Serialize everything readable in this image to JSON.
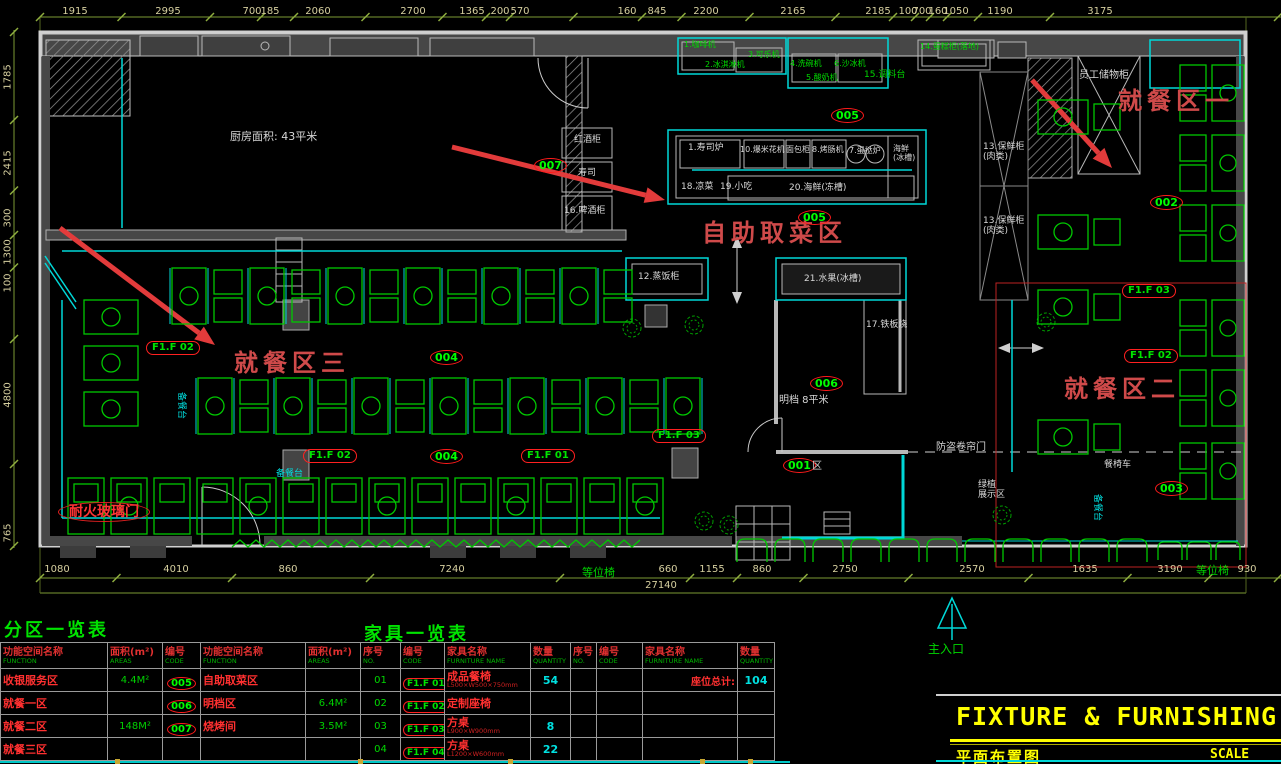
{
  "titles": {
    "zone_table": "分区一览表",
    "furniture_table": "家具一览表",
    "fixture_en": "FIXTURE & FURNISHING P",
    "plan_cn": "平面布置图",
    "scale": "SCALE"
  },
  "colors": {
    "furniture_green": "#00c800",
    "counter_cyan": "#00d8d8",
    "label_red": "#cf4a4a",
    "code_green": "#00ff00",
    "dim_tan": "#d6cf9f",
    "title_yellow": "#ffff00",
    "wall_gray": "#474747"
  },
  "dims": {
    "top": [
      {
        "t": "1915",
        "x": 75
      },
      {
        "t": "2995",
        "x": 168
      },
      {
        "t": "700",
        "x": 252
      },
      {
        "t": "185",
        "x": 270
      },
      {
        "t": "2060",
        "x": 318
      },
      {
        "t": "2700",
        "x": 413
      },
      {
        "t": "1365",
        "x": 472
      },
      {
        "t": "200",
        "x": 500
      },
      {
        "t": "570",
        "x": 520
      },
      {
        "t": "160",
        "x": 627
      },
      {
        "t": "845",
        "x": 657
      },
      {
        "t": "2200",
        "x": 706
      },
      {
        "t": "2165",
        "x": 793
      },
      {
        "t": "2185",
        "x": 878
      },
      {
        "t": "100",
        "x": 908
      },
      {
        "t": "700",
        "x": 922
      },
      {
        "t": "160",
        "x": 938
      },
      {
        "t": "1050",
        "x": 956
      },
      {
        "t": "1190",
        "x": 1000
      },
      {
        "t": "3175",
        "x": 1100
      }
    ],
    "left": [
      {
        "t": "1785",
        "y": 77
      },
      {
        "t": "2415",
        "y": 163
      },
      {
        "t": "300",
        "y": 218
      },
      {
        "t": "1300",
        "y": 252
      },
      {
        "t": "100",
        "y": 283
      },
      {
        "t": "4800",
        "y": 395
      },
      {
        "t": "765",
        "y": 533
      }
    ],
    "bottom": [
      {
        "t": "1080",
        "x": 57
      },
      {
        "t": "4010",
        "x": 176
      },
      {
        "t": "860",
        "x": 288
      },
      {
        "t": "7240",
        "x": 452
      },
      {
        "t": "660",
        "x": 668
      },
      {
        "t": "1155",
        "x": 712
      },
      {
        "t": "860",
        "x": 762
      },
      {
        "t": "2750",
        "x": 845
      },
      {
        "t": "2570",
        "x": 972
      },
      {
        "t": "1635",
        "x": 1085
      },
      {
        "t": "3190",
        "x": 1170
      },
      {
        "t": "930",
        "x": 1247
      }
    ],
    "total": {
      "t": "27140",
      "x": 661,
      "y": 580
    }
  },
  "plan": {
    "area_labels": [
      {
        "t": "就餐区一",
        "x": 1118,
        "y": 88
      },
      {
        "t": "自助取菜区",
        "x": 702,
        "y": 220
      },
      {
        "t": "就餐区三",
        "x": 234,
        "y": 350
      },
      {
        "t": "就餐区二",
        "x": 1064,
        "y": 376
      }
    ],
    "codes": [
      {
        "t": "005",
        "x": 831,
        "y": 108
      },
      {
        "t": "007",
        "x": 534,
        "y": 158
      },
      {
        "t": "005",
        "x": 798,
        "y": 210
      },
      {
        "t": "006",
        "x": 810,
        "y": 376
      },
      {
        "t": "004",
        "x": 430,
        "y": 350
      },
      {
        "t": "004",
        "x": 430,
        "y": 449
      },
      {
        "t": "002",
        "x": 1150,
        "y": 195
      },
      {
        "t": "003",
        "x": 1155,
        "y": 481
      },
      {
        "t": "001",
        "x": 783,
        "y": 458
      }
    ],
    "ftags": [
      {
        "t": "F1.F 03",
        "x": 1122,
        "y": 284
      },
      {
        "t": "F1.F 02",
        "x": 1124,
        "y": 349
      },
      {
        "t": "F1.F 02",
        "x": 146,
        "y": 341
      },
      {
        "t": "F1.F 02",
        "x": 303,
        "y": 449
      },
      {
        "t": "F1.F 01",
        "x": 521,
        "y": 449
      },
      {
        "t": "F1.F 03",
        "x": 652,
        "y": 429
      }
    ],
    "white_labels": [
      {
        "t": "厨房面积: 43平米",
        "x": 230,
        "y": 131,
        "s": 11
      },
      {
        "t": "员工储物柜",
        "x": 1079,
        "y": 70,
        "s": 10
      },
      {
        "t": "13.保鲜柜\n(肉类)",
        "x": 983,
        "y": 142,
        "s": 9
      },
      {
        "t": "13.保鲜柜\n(肉类)",
        "x": 983,
        "y": 216,
        "s": 9
      },
      {
        "t": "红酒柜",
        "x": 574,
        "y": 135,
        "s": 9
      },
      {
        "t": "寿司",
        "x": 578,
        "y": 168,
        "s": 9
      },
      {
        "t": "16.啤酒柜",
        "x": 564,
        "y": 206,
        "s": 9
      },
      {
        "t": "1.寿司炉",
        "x": 688,
        "y": 143,
        "s": 9
      },
      {
        "t": "10.爆米花机",
        "x": 740,
        "y": 145,
        "s": 8
      },
      {
        "t": "面包柜",
        "x": 786,
        "y": 145,
        "s": 8
      },
      {
        "t": "8.烤肠机",
        "x": 812,
        "y": 145,
        "s": 8
      },
      {
        "t": "7.蛋挞炉",
        "x": 849,
        "y": 146,
        "s": 8
      },
      {
        "t": "海鲜\n(冰槽)",
        "x": 893,
        "y": 144,
        "s": 8
      },
      {
        "t": "18.凉菜",
        "x": 681,
        "y": 182,
        "s": 9
      },
      {
        "t": "19.小吃",
        "x": 720,
        "y": 182,
        "s": 9
      },
      {
        "t": "20.海鲜(冻槽)",
        "x": 789,
        "y": 183,
        "s": 9
      },
      {
        "t": "12.蒸饭柜",
        "x": 638,
        "y": 272,
        "s": 9
      },
      {
        "t": "21.水果(冰槽)",
        "x": 804,
        "y": 274,
        "s": 9
      },
      {
        "t": "17.铁板烧",
        "x": 866,
        "y": 320,
        "s": 9
      },
      {
        "t": "明档 8平米",
        "x": 779,
        "y": 395,
        "s": 10
      },
      {
        "t": "防盗卷帘门",
        "x": 936,
        "y": 442,
        "s": 10
      },
      {
        "t": "绿植\n展示区",
        "x": 978,
        "y": 480,
        "s": 9
      },
      {
        "t": "餐椅车",
        "x": 1104,
        "y": 460,
        "s": 9
      },
      {
        "t": "区",
        "x": 812,
        "y": 461,
        "s": 10
      }
    ],
    "green_labels": [
      {
        "t": "1.咖啡机",
        "x": 684,
        "y": 40,
        "s": 8
      },
      {
        "t": "2.冰淇淋机",
        "x": 705,
        "y": 60,
        "s": 8
      },
      {
        "t": "3.可乐机",
        "x": 748,
        "y": 50,
        "s": 8
      },
      {
        "t": "4.洗碗机",
        "x": 790,
        "y": 59,
        "s": 8
      },
      {
        "t": "6.沙冰机",
        "x": 834,
        "y": 59,
        "s": 8
      },
      {
        "t": "5.酸奶机",
        "x": 806,
        "y": 73,
        "s": 8
      },
      {
        "t": "15.调料台",
        "x": 864,
        "y": 70,
        "s": 9
      },
      {
        "t": "14.蛋糕柜(落地)",
        "x": 920,
        "y": 42,
        "s": 8
      },
      {
        "t": "等位椅",
        "x": 582,
        "y": 567,
        "s": 11
      },
      {
        "t": "等位椅",
        "x": 1196,
        "y": 565,
        "s": 11
      },
      {
        "t": "主入口",
        "x": 928,
        "y": 643,
        "s": 12
      }
    ],
    "cyan_labels": [
      {
        "t": "备餐台",
        "x": 186,
        "y": 392,
        "s": 9,
        "rot": 90
      },
      {
        "t": "备餐台",
        "x": 276,
        "y": 469,
        "s": 9
      },
      {
        "t": "备餐台",
        "x": 1102,
        "y": 494,
        "s": 9,
        "rot": 90
      }
    ],
    "red_labels": [
      {
        "t": "耐火玻璃门",
        "x": 58,
        "y": 502,
        "s": 14
      }
    ],
    "arrows": [
      {
        "x1": 452,
        "y1": 147,
        "x2": 665,
        "y2": 200
      },
      {
        "x1": 1032,
        "y1": 80,
        "x2": 1112,
        "y2": 168
      },
      {
        "x1": 60,
        "y1": 228,
        "x2": 215,
        "y2": 345
      }
    ],
    "trees": [
      {
        "x": 632,
        "y": 328
      },
      {
        "x": 694,
        "y": 325
      },
      {
        "x": 704,
        "y": 521
      },
      {
        "x": 729,
        "y": 525
      },
      {
        "x": 1002,
        "y": 515
      },
      {
        "x": 1046,
        "y": 322
      }
    ]
  },
  "zone_table": {
    "headers": [
      {
        "cn": "功能空间名称",
        "en": "FUNCTION"
      },
      {
        "cn": "面积(m²)",
        "en": "AREAS"
      },
      {
        "cn": "编号",
        "en": "CODE"
      },
      {
        "cn": "功能空间名称",
        "en": "FUNCTION"
      },
      {
        "cn": "面积(m²)",
        "en": "AREAS"
      }
    ],
    "rows": [
      {
        "name": "收银服务区",
        "area": "4.4M²",
        "code": "005",
        "name2": "自助取菜区",
        "area2": ""
      },
      {
        "name": "就餐一区",
        "area": "",
        "code": "006",
        "name2": "明档区",
        "area2": "6.4M²"
      },
      {
        "name": "就餐二区",
        "area": "148M²",
        "code": "007",
        "name2": "烧烤间",
        "area2": "3.5M²"
      },
      {
        "name": "就餐三区",
        "area": "",
        "code": "",
        "name2": "",
        "area2": ""
      }
    ]
  },
  "furniture_table": {
    "headers": [
      {
        "cn": "序号",
        "en": "NO."
      },
      {
        "cn": "编号",
        "en": "CODE"
      },
      {
        "cn": "家具名称",
        "en": "FURNITURE NAME"
      },
      {
        "cn": "数量",
        "en": "QUANTITY"
      },
      {
        "cn": "序号",
        "en": "NO."
      },
      {
        "cn": "编号",
        "en": "CODE"
      },
      {
        "cn": "家具名称",
        "en": "FURNITURE NAME"
      },
      {
        "cn": "数量",
        "en": "QUANTITY"
      }
    ],
    "rows": [
      {
        "no": "01",
        "code": "F1.F 01",
        "name": "成品餐椅",
        "spec": "L500×W500×750mm",
        "qty": "54",
        "name2": "座位总计:",
        "qty2": "104"
      },
      {
        "no": "02",
        "code": "F1.F 02",
        "name": "定制座椅",
        "spec": "",
        "qty": "",
        "name2": "",
        "qty2": ""
      },
      {
        "no": "03",
        "code": "F1.F 03",
        "name": "方桌",
        "spec": "L900×W900mm",
        "qty": "8",
        "name2": "",
        "qty2": ""
      },
      {
        "no": "04",
        "code": "F1.F 04",
        "name": "方桌",
        "spec": "L1200×W600mm",
        "qty": "22",
        "name2": "",
        "qty2": ""
      }
    ]
  }
}
